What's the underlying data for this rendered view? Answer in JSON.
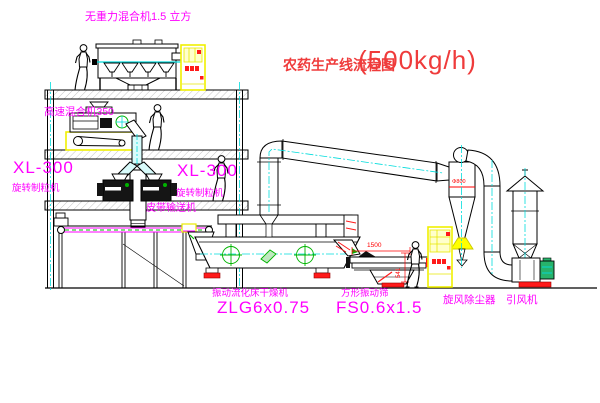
{
  "title": {
    "text": "农药生产线流程图",
    "capacity": "(500kg/h)"
  },
  "labels": {
    "gravity_mixer": "无重力混合机1.5 立方",
    "high_speed_mixer": "高速混合机350",
    "xl300": "XL-300",
    "rotary_granulator": "旋转制粒机",
    "belt_conveyor": "皮带输送机",
    "dryer_name": "振动流化床干燥机",
    "dryer_model": "ZLG6x0.75",
    "screen_name": "方形振动筛",
    "screen_model": "FS0.6x1.5",
    "cyclone": "旋风除尘器",
    "fan": "引风机"
  },
  "dimensions": {
    "screen_length": "1500",
    "screen_stand_height": "541",
    "cyclone_marking": "Φ800"
  },
  "colors": {
    "label_magenta": "#ff00ff",
    "title_red": "#ef3b3b",
    "line_black": "#000000",
    "centerline_cyan": "#00dcdc",
    "cabinet_yellow": "#ffff00",
    "accent_red": "#ff1a1a",
    "detail_green": "#00b400"
  }
}
